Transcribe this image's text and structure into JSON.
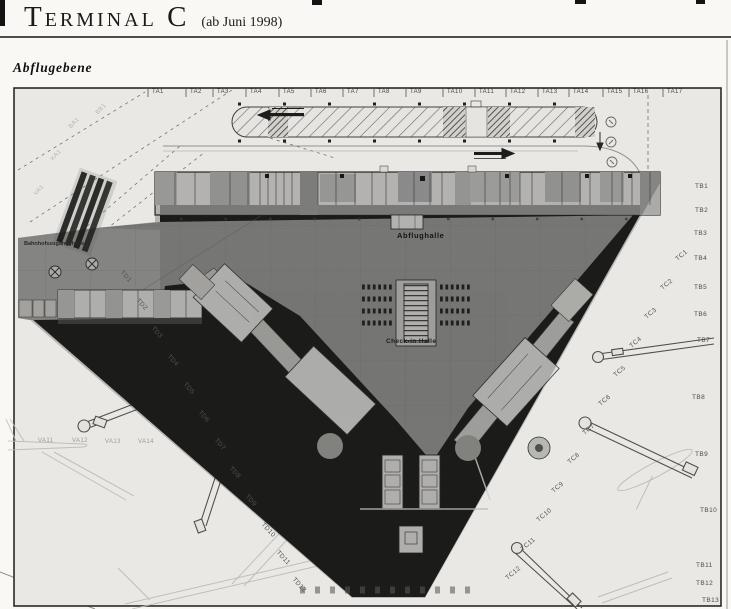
{
  "page": {
    "title": "Terminal C",
    "title_suffix": "(ab Juni 1998)",
    "level_label": "Abflugebene"
  },
  "plan": {
    "hall_label": "Abflughalle",
    "checkin_label": "Check-in Halle",
    "station_label": "Bahnhofszugangshalle",
    "ta": [
      "TA1",
      "TA2",
      "TA3",
      "TA4",
      "TA5",
      "TA6",
      "TA7",
      "TA8",
      "TA9",
      "TA10",
      "TA11",
      "TA12",
      "TA13",
      "TA14",
      "TA15",
      "TA16",
      "TA17"
    ],
    "tb": [
      "TB1",
      "TB2",
      "TB3",
      "TB4",
      "TB5",
      "TB6",
      "TB7",
      "TB8",
      "TB9",
      "TB10",
      "TB11",
      "TB12",
      "TB13"
    ],
    "tc": [
      "TC1",
      "TC2",
      "TC3",
      "TC4",
      "TC5",
      "TC6",
      "TC7",
      "TC8",
      "TC9",
      "TC10",
      "TC11",
      "TC12"
    ],
    "td": [
      "TD1",
      "TD2",
      "TD3",
      "TD4",
      "TD5",
      "TD6",
      "TD7",
      "TD8",
      "TD9",
      "TD10",
      "TD11",
      "TD12"
    ],
    "va": [
      "VA11",
      "VA12",
      "VA13",
      "VA14"
    ],
    "faint": [
      "BB1",
      "BA1",
      "KA1",
      "VA1"
    ]
  },
  "colors": {
    "paper": "#f9f8f5",
    "ink": "#1a1a1a",
    "hall_gray": "#a0a09e",
    "wall_dark": "#262624"
  }
}
